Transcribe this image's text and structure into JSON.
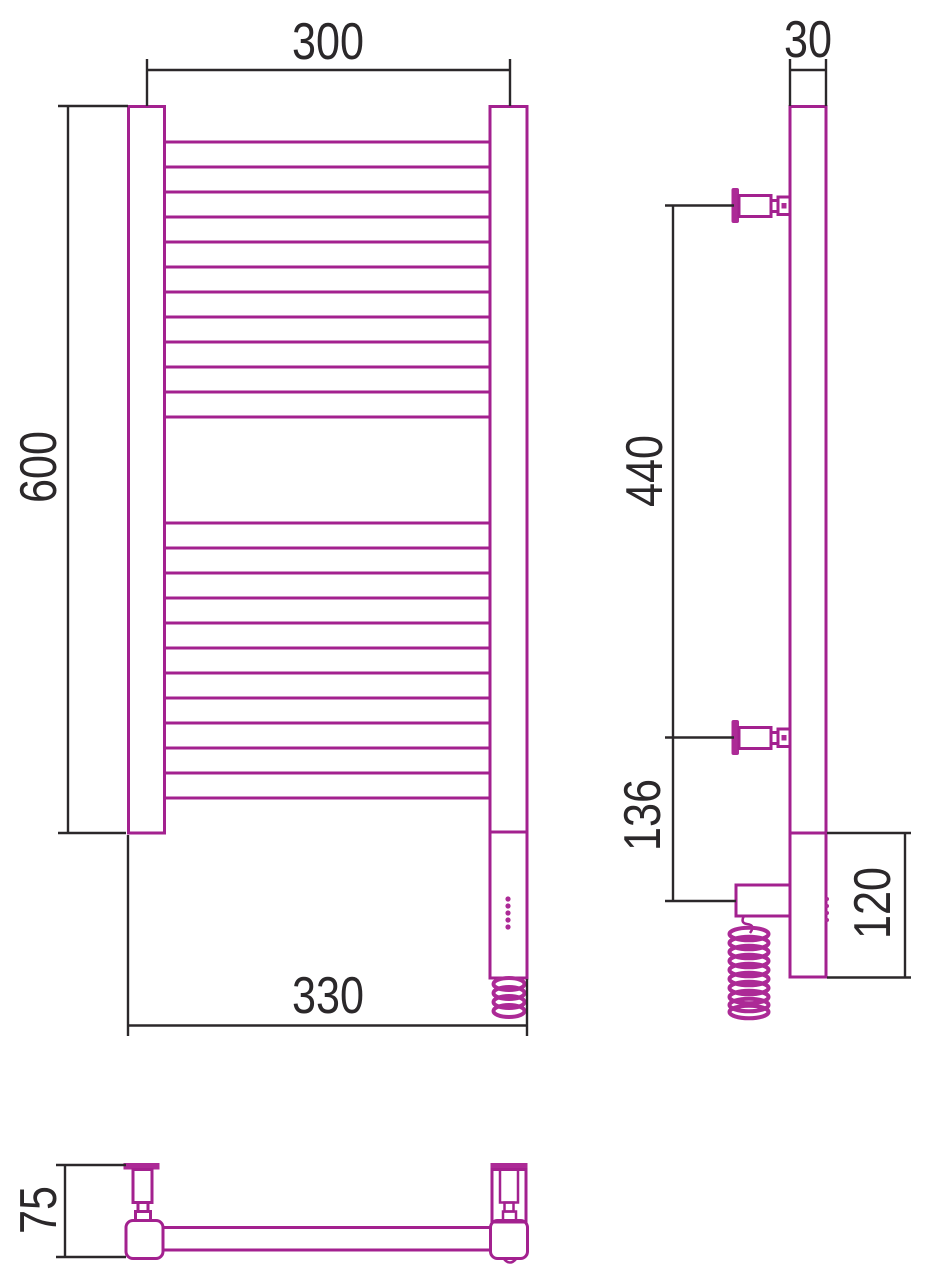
{
  "drawing": {
    "product": "heated towel rail technical drawing, three orthographic views",
    "dimensions": {
      "front": {
        "axis_width": "300",
        "height": "600",
        "overall_width": "330"
      },
      "side": {
        "depth": "30",
        "bracket_spacing": "440",
        "heater_offset": "136",
        "bottom_depth": "120"
      },
      "bottom": {
        "depth": "75"
      }
    },
    "colors": {
      "product_line": "#A3218F",
      "product_line_bold": "#AC2A96",
      "dimension_line": "#2B282A",
      "background": "#FFFFFF"
    }
  },
  "front_view": {
    "rails": {
      "x1": 164.5,
      "x2": 490,
      "groups": [
        {
          "y_start": 142,
          "count": 12,
          "pitch": 25
        },
        {
          "y_start": 523,
          "count": 12,
          "pitch": 25
        }
      ]
    }
  }
}
